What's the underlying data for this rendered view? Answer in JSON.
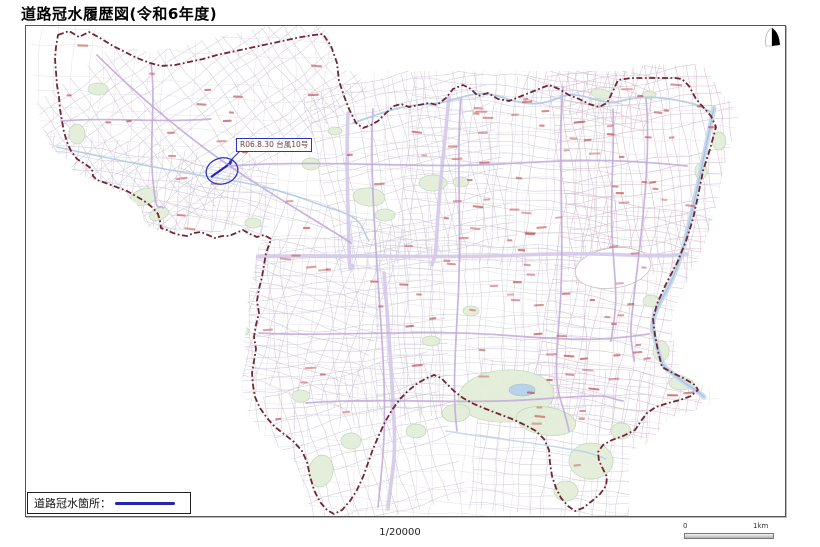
{
  "page": {
    "title": "道路冠水履歴図(令和6年度)"
  },
  "annotation": {
    "label": "R06.8.30 台風10号"
  },
  "legend": {
    "label": "道路冠水箇所：",
    "line_color": "#2525b5"
  },
  "footer": {
    "scale_text": "1/20000",
    "scale_bar": {
      "start": "0",
      "end": "1km"
    }
  },
  "colors": {
    "boundary": "#6e2733",
    "street_base": "#dfdbe2",
    "street": "#cfc6d8",
    "street_east": "#d6bece",
    "arterial": "#bfa8da",
    "arterial_wide": "#d4c9ea",
    "river": "#aecbe6",
    "river_wide": "#c6daee",
    "river_core": "#9cb9d6",
    "pond": "#b8d2ea",
    "park": "#e3eeda",
    "park_stroke": "#bed6b2",
    "open_area": "#ffffff",
    "open_area_stroke": "#c6c2ca",
    "place_label": "#c25252",
    "annotation_blue": "#2a35c0",
    "flood_line": "#2525b5",
    "north_arrow": "#000000"
  }
}
